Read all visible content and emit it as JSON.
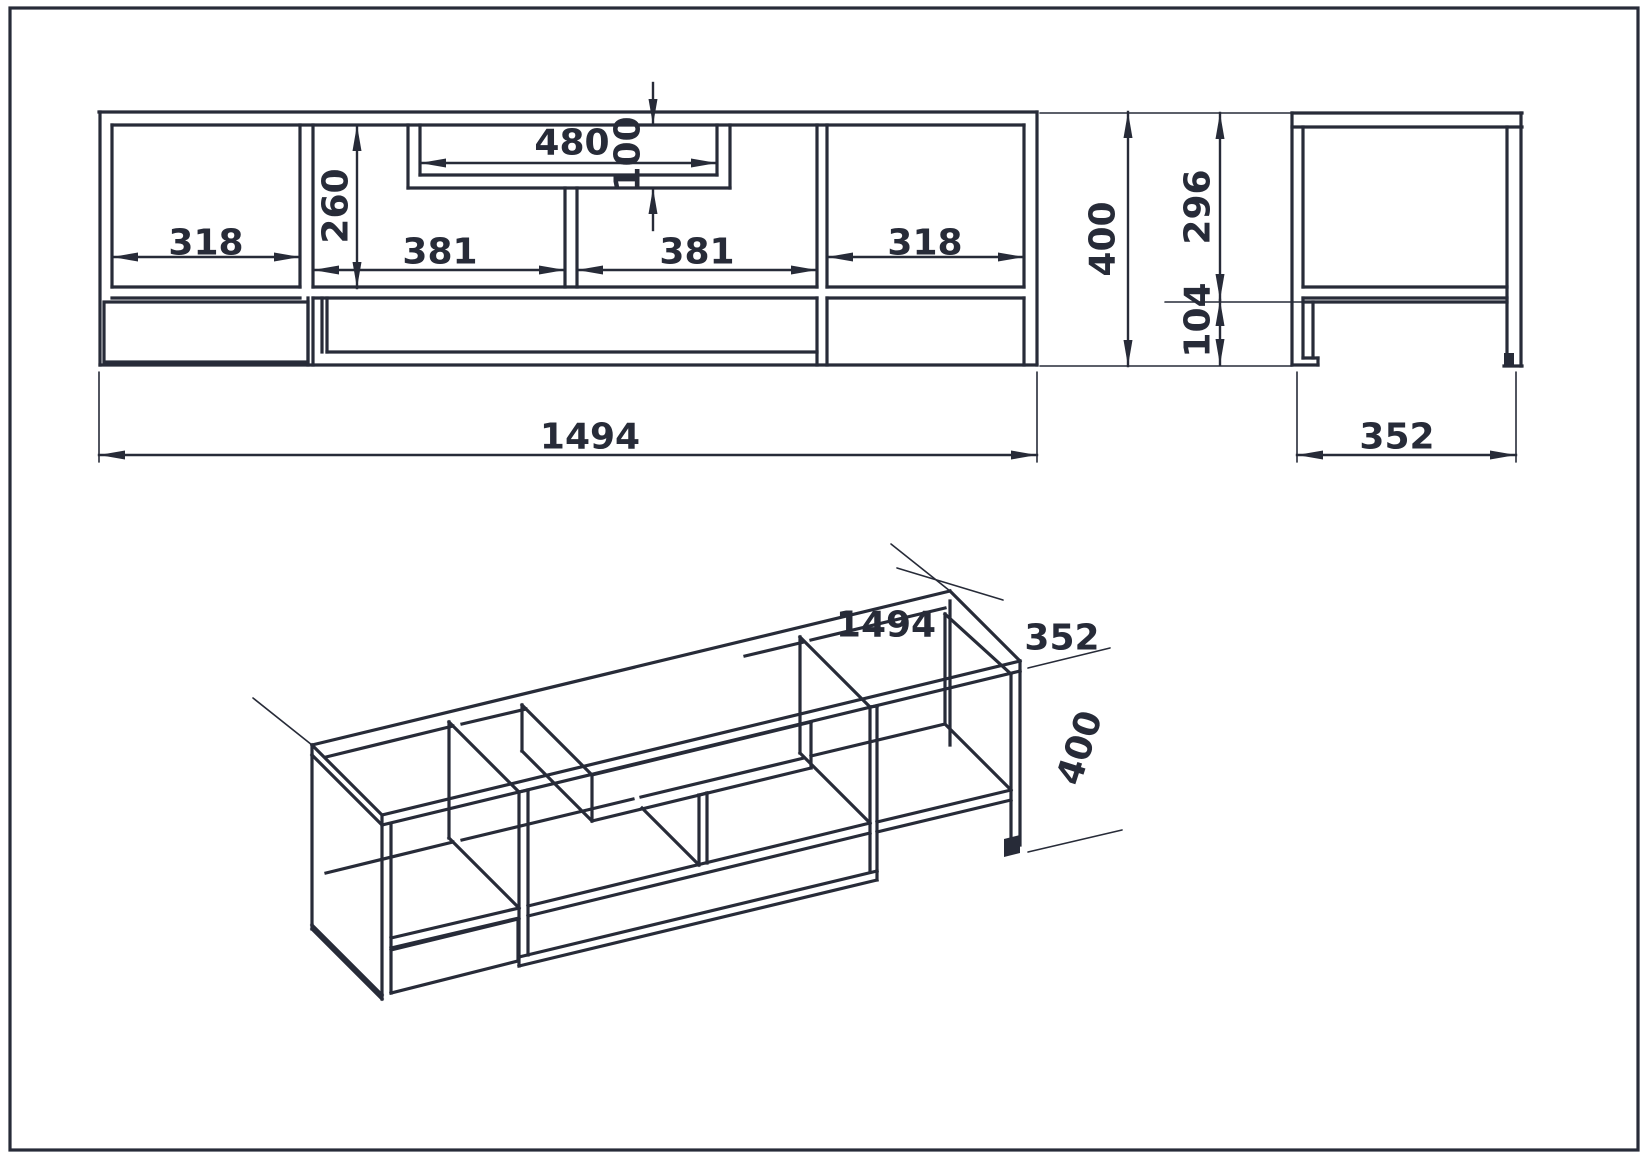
{
  "colors": {
    "ink": "#272b38",
    "background": "#ffffff"
  },
  "front_view": {
    "left_niche_width": "318",
    "right_niche_width": "318",
    "niche_height": "260",
    "tv_niche_width": "480",
    "tv_niche_height": "100",
    "left_opening_width": "381",
    "right_opening_width": "381",
    "overall_width": "1494",
    "overall_height": "400"
  },
  "side_view": {
    "body_height": "296",
    "leg_height": "104",
    "overall_depth": "352"
  },
  "isometric_view": {
    "overall_width": "1494",
    "overall_depth": "352",
    "overall_height": "400"
  }
}
